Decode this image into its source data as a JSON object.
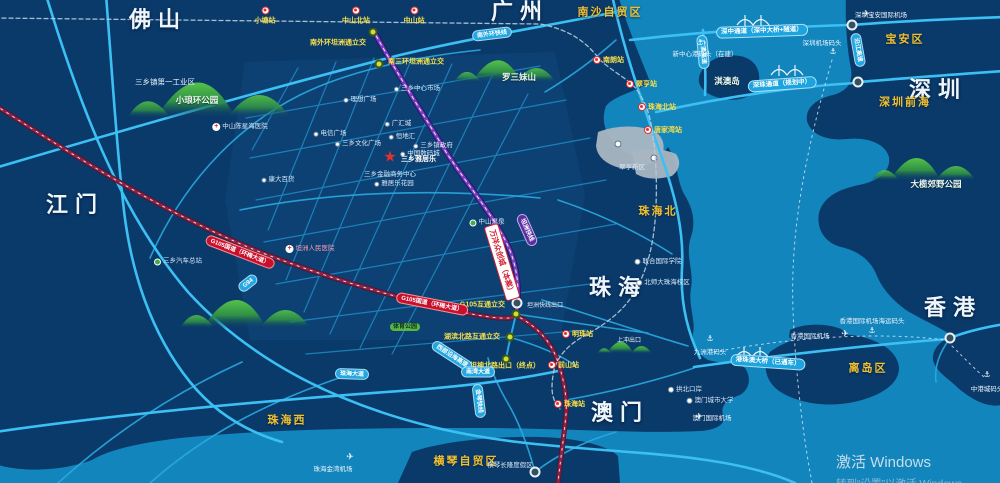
{
  "colors": {
    "land": "#0a3a6a",
    "water": "#1285bd",
    "road": "#3cc0f4",
    "rail_red": "#8c2344",
    "expressway_purple": "#7a3fc0",
    "label_yellow": "#f2c12e",
    "hill_green": "#46ad3c",
    "star_red": "#e8302a",
    "capsule_red": "#c8102e",
    "gray_zone": "#a9b6c2"
  },
  "map": {
    "cities": [
      {
        "label": "佛山",
        "x": 158,
        "y": 20
      },
      {
        "label": "广州",
        "x": 520,
        "y": 12
      },
      {
        "label": "江门",
        "x": 75,
        "y": 205
      },
      {
        "label": "深圳",
        "x": 938,
        "y": 90
      },
      {
        "label": "珠海",
        "x": 618,
        "y": 288
      },
      {
        "label": "澳门",
        "x": 620,
        "y": 413
      },
      {
        "label": "香港",
        "x": 953,
        "y": 308
      }
    ],
    "regions": [
      {
        "label": "南沙自贸区",
        "x": 610,
        "y": 13
      },
      {
        "label": "宝安区",
        "x": 905,
        "y": 40
      },
      {
        "label": "深圳前海",
        "x": 905,
        "y": 103
      },
      {
        "label": "珠海北",
        "x": 658,
        "y": 212
      },
      {
        "label": "珠海西",
        "x": 287,
        "y": 421
      },
      {
        "label": "横琴自贸区",
        "x": 466,
        "y": 462
      },
      {
        "label": "离岛区",
        "x": 868,
        "y": 369
      }
    ],
    "parks": [
      {
        "label": "小琅环公园",
        "x": 197,
        "y": 100
      },
      {
        "label": "罗三妹山",
        "x": 519,
        "y": 77
      },
      {
        "label": "大榄郊野公园",
        "x": 936,
        "y": 184
      },
      {
        "label": "淇澳岛",
        "x": 727,
        "y": 81
      }
    ],
    "stations_top": [
      {
        "label": "小塘站",
        "x": 265,
        "y": 16
      },
      {
        "label": "中山北站",
        "x": 356,
        "y": 16
      },
      {
        "label": "中山站",
        "x": 414,
        "y": 16
      }
    ],
    "stations_side": [
      {
        "label": "南朗站",
        "x": 597,
        "y": 60
      },
      {
        "label": "翠亨站",
        "x": 630,
        "y": 84
      },
      {
        "label": "珠海北站",
        "x": 642,
        "y": 107
      },
      {
        "label": "唐家湾站",
        "x": 648,
        "y": 130
      },
      {
        "label": "明珠站",
        "x": 566,
        "y": 334
      },
      {
        "label": "前山站",
        "x": 552,
        "y": 365
      },
      {
        "label": "珠海站",
        "x": 558,
        "y": 404
      }
    ],
    "interchange_labels": [
      {
        "label": "南外环坦洲通立交",
        "x": 366,
        "y": 43,
        "anchor": "r"
      },
      {
        "label": "南三环坦洲通立交",
        "x": 388,
        "y": 62,
        "anchor": "l"
      },
      {
        "label": "G105互通立交",
        "x": 505,
        "y": 305,
        "anchor": "r"
      },
      {
        "label": "湖滨北路互通立交",
        "x": 500,
        "y": 337,
        "anchor": "r"
      },
      {
        "label": "坦神北路出口（终点）",
        "x": 470,
        "y": 366,
        "anchor": "l"
      }
    ],
    "exit_labels": [
      {
        "label": "坦洲快线出口",
        "x": 527,
        "y": 306,
        "anchor": "l"
      },
      {
        "label": "上冲出口",
        "x": 617,
        "y": 341,
        "anchor": "l"
      }
    ],
    "capsules": [
      {
        "label": "南外环快线",
        "x": 492,
        "y": 34,
        "rot": -7,
        "kind": "cyan"
      },
      {
        "label": "G94",
        "x": 248,
        "y": 283,
        "rot": -38,
        "kind": "cyan"
      },
      {
        "label": "G105国道（环梅大道）",
        "x": 240,
        "y": 252,
        "rot": 21,
        "kind": "red"
      },
      {
        "label": "G105国道（环梅大道）",
        "x": 432,
        "y": 304,
        "rot": 11,
        "kind": "red"
      },
      {
        "label": "坦洲快线",
        "x": 527,
        "y": 230,
        "rot": 66,
        "kind": "purple"
      },
      {
        "label": "深中通道（深中大桥+隧道）",
        "x": 762,
        "y": 31,
        "rot": -2,
        "kind": "cyanBig"
      },
      {
        "label": "深珠通道（规划中）",
        "x": 782,
        "y": 84,
        "rot": -4,
        "kind": "cyanBig"
      },
      {
        "label": "港珠澳大桥（已通车）",
        "x": 768,
        "y": 362,
        "rot": 4,
        "kind": "cyanBig"
      },
      {
        "label": "西部沿海高速",
        "x": 452,
        "y": 356,
        "rot": 33,
        "kind": "cyan"
      },
      {
        "label": "珠海大道",
        "x": 352,
        "y": 374,
        "rot": 2,
        "kind": "cyan"
      },
      {
        "label": "南湾大道",
        "x": 478,
        "y": 372,
        "rot": 0,
        "kind": "cyan"
      },
      {
        "label": "金琴快线",
        "x": 479,
        "y": 401,
        "rot": 83,
        "kind": "cyan"
      },
      {
        "label": "沿江高速",
        "x": 858,
        "y": 50,
        "rot": 80,
        "kind": "cyan"
      },
      {
        "label": "广澳高速",
        "x": 703,
        "y": 52,
        "rot": 85,
        "kind": "cyan"
      }
    ],
    "pois": [
      {
        "label": "三乡镇第一工业区",
        "x": 165,
        "y": 82,
        "icon": "none",
        "big": true
      },
      {
        "label": "中山陈星海医院",
        "x": 240,
        "y": 127,
        "icon": "cross"
      },
      {
        "label": "三乡中心市场",
        "x": 417,
        "y": 89,
        "icon": "dot"
      },
      {
        "label": "理想广场",
        "x": 360,
        "y": 100,
        "icon": "dot"
      },
      {
        "label": "广汇城",
        "x": 398,
        "y": 124,
        "icon": "dot"
      },
      {
        "label": "电信广场",
        "x": 330,
        "y": 134,
        "icon": "dot"
      },
      {
        "label": "恒地汇",
        "x": 402,
        "y": 137,
        "icon": "dot"
      },
      {
        "label": "三乡文化广场",
        "x": 358,
        "y": 144,
        "icon": "dot"
      },
      {
        "label": "三乡镇政府",
        "x": 433,
        "y": 146,
        "icon": "dot"
      },
      {
        "label": "中国数码城",
        "x": 420,
        "y": 154,
        "icon": "dot"
      },
      {
        "label": "三乡金融商务中心",
        "x": 390,
        "y": 175,
        "icon": "none"
      },
      {
        "label": "雅居乐花园",
        "x": 394,
        "y": 184,
        "icon": "dot"
      },
      {
        "label": "康大百货",
        "x": 278,
        "y": 180,
        "icon": "dot"
      },
      {
        "label": "坦洲人民医院",
        "x": 310,
        "y": 249,
        "icon": "cross",
        "color": "#ff9bb5"
      },
      {
        "label": "三乡汽车总站",
        "x": 178,
        "y": 262,
        "icon": "green"
      },
      {
        "label": "中山温泉",
        "x": 487,
        "y": 223,
        "icon": "green"
      },
      {
        "label": "体育公园",
        "x": 405,
        "y": 327,
        "icon": "greencap"
      },
      {
        "label": "联合国际学院",
        "x": 658,
        "y": 262,
        "icon": "circle"
      },
      {
        "label": "北师大珠海校区",
        "x": 663,
        "y": 283,
        "icon": "circle"
      },
      {
        "label": "翠亨新区",
        "x": 632,
        "y": 168,
        "icon": "none"
      },
      {
        "label": "拱北口岸",
        "x": 685,
        "y": 390,
        "icon": "circle"
      },
      {
        "label": "澳门城市大学",
        "x": 710,
        "y": 401,
        "icon": "circle"
      },
      {
        "label": "横琴长隆度假区",
        "x": 510,
        "y": 466,
        "icon": "none"
      }
    ],
    "ports": [
      {
        "label": "新中心港码头（在建）",
        "x": 705,
        "y": 53,
        "ax": 700,
        "ay": 43
      },
      {
        "label": "深圳机场码头",
        "x": 822,
        "y": 42,
        "ax": 833,
        "ay": 52
      },
      {
        "label": "九洲港码头",
        "x": 710,
        "y": 351,
        "ax": 710,
        "ay": 339
      },
      {
        "label": "香港国际机场海运码头",
        "x": 872,
        "y": 320,
        "ax": 872,
        "ay": 331
      },
      {
        "label": "中港城码头",
        "x": 987,
        "y": 388,
        "ax": 987,
        "ay": 375
      }
    ],
    "airports": [
      {
        "label": "深圳宝安国际机场",
        "x": 881,
        "y": 14,
        "px": 866,
        "py": 14
      },
      {
        "label": "香港国际机场",
        "x": 810,
        "y": 335,
        "px": 845,
        "py": 334
      },
      {
        "label": "澳门国际机场",
        "x": 712,
        "y": 417,
        "px": 699,
        "py": 417
      },
      {
        "label": "珠海金湾机场",
        "x": 333,
        "y": 468,
        "px": 350,
        "py": 457
      }
    ],
    "interchange_dots": [
      [
        373,
        32
      ],
      [
        379,
        64
      ],
      [
        516,
        314
      ],
      [
        510,
        337
      ],
      [
        506,
        359
      ]
    ],
    "junction_rings": [
      [
        517,
        303
      ],
      [
        852,
        25
      ],
      [
        858,
        82
      ],
      [
        950,
        338
      ],
      [
        535,
        472
      ]
    ],
    "bridge_icons": [
      [
        753,
        20
      ],
      [
        787,
        70
      ],
      [
        752,
        352
      ]
    ],
    "hills": [
      [
        225,
        95,
        1.25
      ],
      [
        515,
        68,
        0.78
      ],
      [
        258,
        310,
        1.0
      ],
      [
        934,
        166,
        0.8
      ],
      [
        630,
        346,
        0.42
      ]
    ],
    "project": {
      "star_label": "三乡雅居乐",
      "star_x": 390,
      "star_y": 157,
      "badge_label": "万洋众创城（本案）",
      "badge_x": 502,
      "badge_y": 262,
      "badge_rot": 73
    },
    "watermark": {
      "line1": "激活 Windows",
      "line2": "转到“设置”以激活 Windows。"
    }
  }
}
